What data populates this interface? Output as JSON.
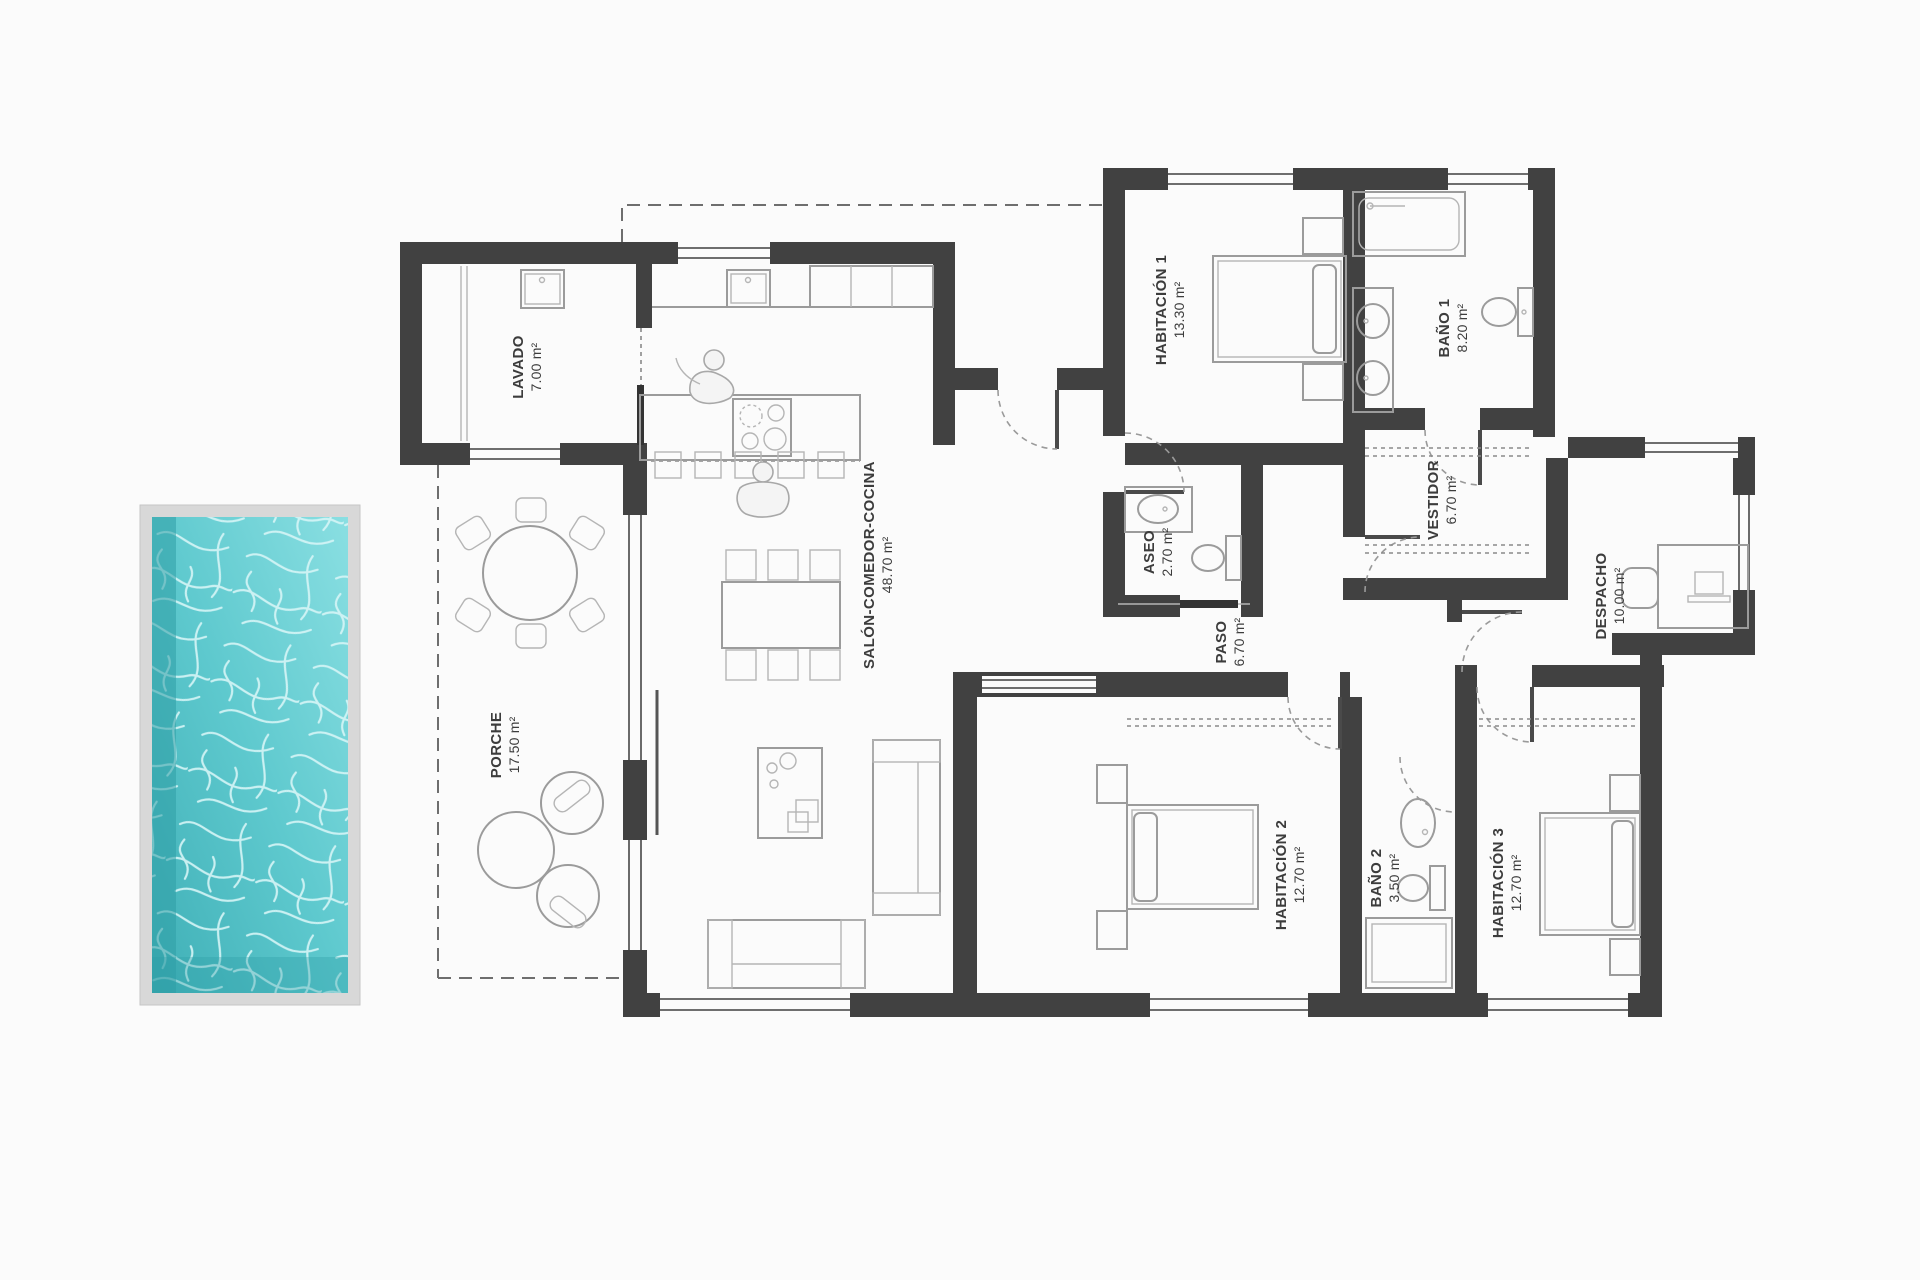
{
  "plan": {
    "type": "floor-plan",
    "language": "es",
    "wall_color": "#414141",
    "furniture_line_color": "#9b9b9b",
    "label_color": "#3c3c3c",
    "background_color": "#fbfbfb"
  },
  "pool": {
    "frame_color": "#d8d8d8",
    "water_color_deep": "#3fafb6",
    "water_color_mid": "#5ec9ce",
    "water_color_light": "#8adfe2",
    "caustic_color": "#d6f5f6"
  },
  "rooms": [
    {
      "id": "lavado",
      "name": "LAVADO",
      "area": "7.00 m²"
    },
    {
      "id": "porche",
      "name": "PORCHE",
      "area": "17.50 m²"
    },
    {
      "id": "salon",
      "name": "SALÓN-COMEDOR-COCINA",
      "area": "48.70 m²"
    },
    {
      "id": "habitacion-1",
      "name": "HABITACIÓN 1",
      "area": "13.30 m²"
    },
    {
      "id": "bano-1",
      "name": "BAÑO 1",
      "area": "8.20 m²"
    },
    {
      "id": "vestidor",
      "name": "VESTIDOR",
      "area": "6.70 m²"
    },
    {
      "id": "aseo",
      "name": "ASEO",
      "area": "2.70 m²"
    },
    {
      "id": "paso",
      "name": "PASO",
      "area": "6.70 m²"
    },
    {
      "id": "despacho",
      "name": "DESPACHO",
      "area": "10.00 m²"
    },
    {
      "id": "habitacion-2",
      "name": "HABITACIÓN 2",
      "area": "12.70 m²"
    },
    {
      "id": "bano-2",
      "name": "BAÑO 2",
      "area": "3.50 m²"
    },
    {
      "id": "habitacion-3",
      "name": "HABITACIÓN 3",
      "area": "12.70 m²"
    }
  ]
}
